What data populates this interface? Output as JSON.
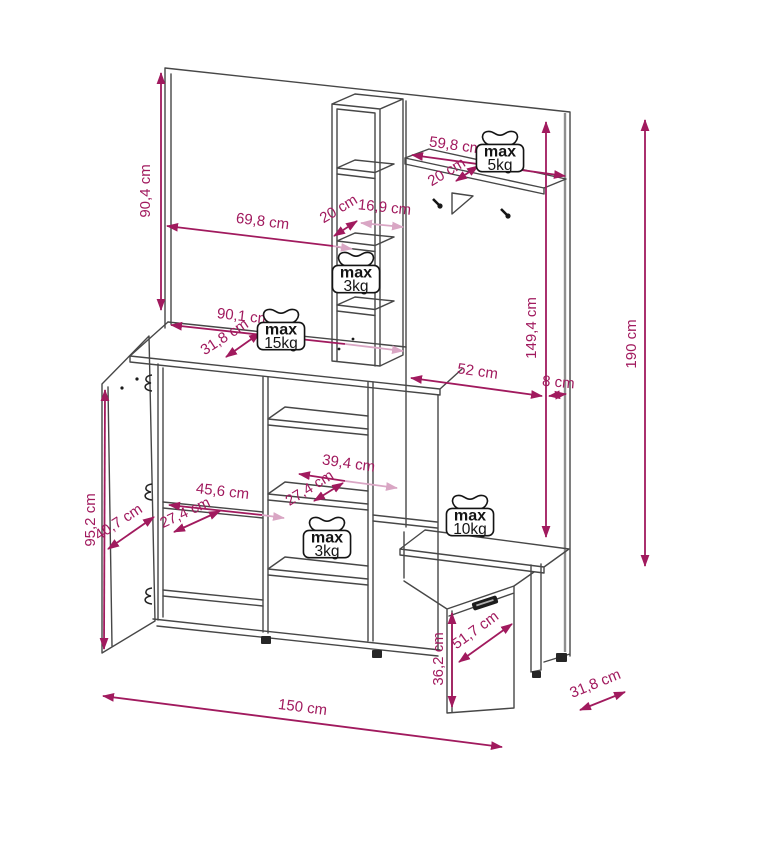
{
  "colors": {
    "dimension": "#a11a5e",
    "dimension_light": "#d9a6c4",
    "drawing_line": "#474747",
    "background": "#ffffff"
  },
  "dimensions": {
    "mirror_height": "90,4 cm",
    "mirror_width": "69,8 cm",
    "column_depth": "20 cm",
    "column_width": "16,9 cm",
    "top_shelf_width": "59,8 cm",
    "top_shelf_depth": "20 cm",
    "cabinet_width": "90,1 cm",
    "cabinet_depth": "31,8 cm",
    "panel_height": "149,4 cm",
    "panel_width": "52 cm",
    "panel_side": "8 cm",
    "total_height": "190 cm",
    "door_height": "95,2 cm",
    "door_width": "40,7 cm",
    "left_shelf_depth": "27,4 cm",
    "left_shelf_width": "45,6 cm",
    "mid_shelf_width": "39,4 cm",
    "mid_shelf_depth": "27,4 cm",
    "bench_flap_height": "36,2 cm",
    "bench_flap_width": "51,7 cm",
    "total_width": "150 cm",
    "total_depth": "31,8 cm"
  },
  "weights": {
    "column_shelf": {
      "label": "max",
      "value": "3kg"
    },
    "top_shelf": {
      "label": "max",
      "value": "5kg"
    },
    "cabinet_top": {
      "label": "max",
      "value": "15kg"
    },
    "mid_shelf": {
      "label": "max",
      "value": "3kg"
    },
    "bench": {
      "label": "max",
      "value": "10kg"
    }
  }
}
